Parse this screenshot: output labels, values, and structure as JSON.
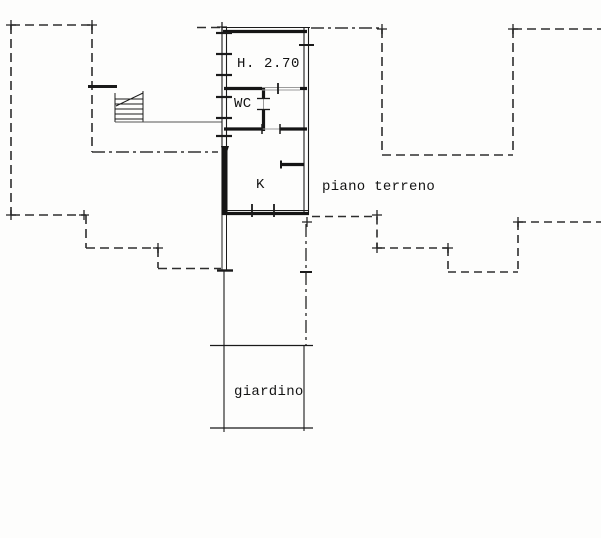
{
  "canvas": {
    "width": 601,
    "height": 538,
    "background": "#fdfdfc"
  },
  "labels": {
    "room_height": "H. 2.70",
    "wc": "WC",
    "kitchen": "K",
    "floor_name": "piano terreno",
    "garden": "giardino"
  },
  "colors": {
    "ink": "#1a1a1a",
    "boundary_dash": "#2e2e2e",
    "light_line": "#9b9b9b"
  }
}
